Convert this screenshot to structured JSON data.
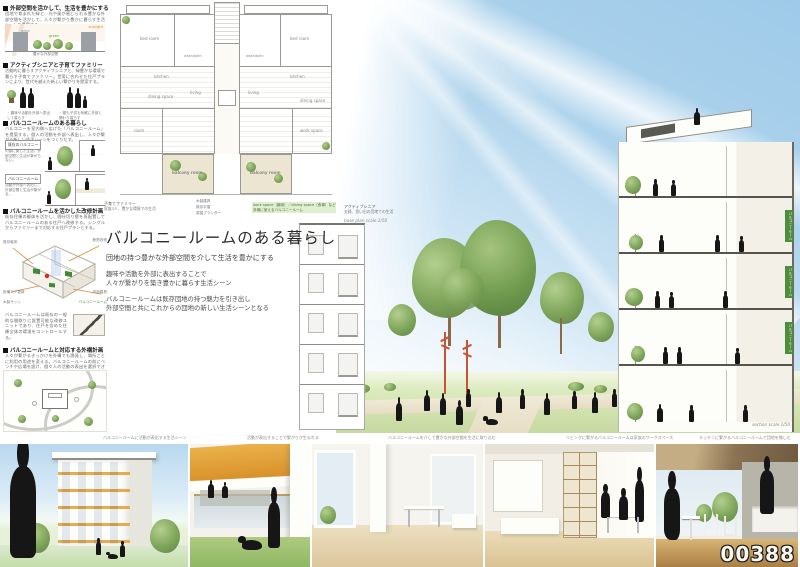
{
  "board": {
    "id_number": "00388"
  },
  "left_sections": [
    {
      "heading": "外部空間を活かして、生活を豊かにする",
      "body": "団地で育まれた緑と、光や風が感じられる豊かな外部空間を活かして、人々が繋がり豊かに暮らす生活シーンを提案する。",
      "labels": {
        "sun": "sunlight",
        "wind": "wind",
        "green": "green",
        "caption": "豊かな外部空間"
      }
    },
    {
      "heading": "アクティブシニアと子育てファミリー",
      "body": "活動的に暮らすアクティブシニアと、緑豊かな環境で暮らす子育てファミリー。世帯に合わせた住戸プランにより、世代を越えた新しい繋がりを提案する。",
      "group1": "アクティブシニア",
      "group2": "子育てファミリー",
      "note1": "・趣味や活動を外部へ表出して暮らす",
      "note2": "・親も子供も気軽に外部と関わり暮らす"
    },
    {
      "heading": "バルコニールームのある暮らし",
      "body": "バルコニーを室内側へ広げた「バルコニールーム」を提案する。個人の活動を外部へ表出し、人々が繋がる新しい生活シーンをつくりだす。",
      "tag1": "既存のバルコニー",
      "tag1_note": "内部に閉じた生活。外部空間と生活が繋がらない。",
      "tag2": "バルコニールーム",
      "tag2_note": "活動が外部へ表出し、外部空間と生活が繋がる。"
    },
    {
      "heading": "バルコニールームを活かした改修計画",
      "body": "既存住棟の躯体を活かし、間仕切り壁を再配置してバルコニールームのある住戸へ改修する。シングルからファミリーまで対応する住戸プランとする。",
      "axon_labels": [
        "既存躯体",
        "断熱改修",
        "設備コア更新",
        "内部建具",
        "木製サッシ",
        "バルコニールーム"
      ],
      "note": "バルコニールームは既存の一般的な間取りに設置可能な改修ユニットであり、住戸を含めた住棟全体の環境をコントロールする。"
    },
    {
      "heading": "バルコニールームと対応する外構計画",
      "body": "人々が繋がるきっかけを外構でも誘発し、場所ごとに利用の用途を変える。バルコニールームの前にベンチや広場を設け、個々人の活動の表出を選択できるよう計画する。"
    }
  ],
  "floor_plan": {
    "rooms": {
      "bed_left": "bed room",
      "bed_right": "bed room",
      "bath_left": "wash/bath",
      "bath_right": "wash/bath",
      "kitchen_left": "kitchen",
      "kitchen_right": "kitchen",
      "dining_left": "dining space",
      "dining_right": "dining space",
      "living_left": "living",
      "living_right": "living",
      "room_left": "room",
      "work_right": "work space",
      "balcony_left": "balcony room",
      "balcony_right": "balcony room"
    },
    "leader_notes": [
      "木製建具",
      "既存手摺",
      "菜園プランター"
    ],
    "green_note": "work space（趣味）／dining space（食事）など多様に使えるバルコニールーム",
    "caption_left_title": "子育てファミリー",
    "caption_left_sub": "家族3人、豊かな環境での生活",
    "caption_right_title": "アクティブシニア",
    "caption_right_sub": "夫婦、思い出の団地での生活",
    "scale": "base plan scale 1/50"
  },
  "title_block": {
    "title": "バルコニールームのある暮らし",
    "subtitle": "団地の持つ豊かな外部空間を介して生活を豊かにする",
    "p1a": "趣味や活動を外部に表出することで",
    "p1b": "人々が繋がりを築き豊かに暮らす生活シーン",
    "p2a": "バルコニールームは既存団地の持つ魅力を引き出し",
    "p2b": "外部空間と共にこれからの団地の新しい生活シーンとなる"
  },
  "perspective": {
    "scale": "section scale 1/50",
    "floor_tags": [
      "バルコニールーム",
      "バルコニールーム",
      "バルコニールーム"
    ]
  },
  "photo_captions": [
    "バルコニールームに活動が表出する生活シーン",
    "活動が表出することで繋がりが生まれる",
    "バルコニールームを介して豊かな外部空間を生活に取り込む",
    "リビングに繋がるバルコニールームは家族のワークスペース",
    "キッチンに繋がるバルコニールームで団地を愉しむ"
  ],
  "colors": {
    "sky": "#a9cfe9",
    "tree": "#7ea55a",
    "lawn": "#cfe0ac",
    "accent_orange": "#e8a23c",
    "red_tree": "#c85433",
    "tag_green": "#4e8d3c"
  }
}
